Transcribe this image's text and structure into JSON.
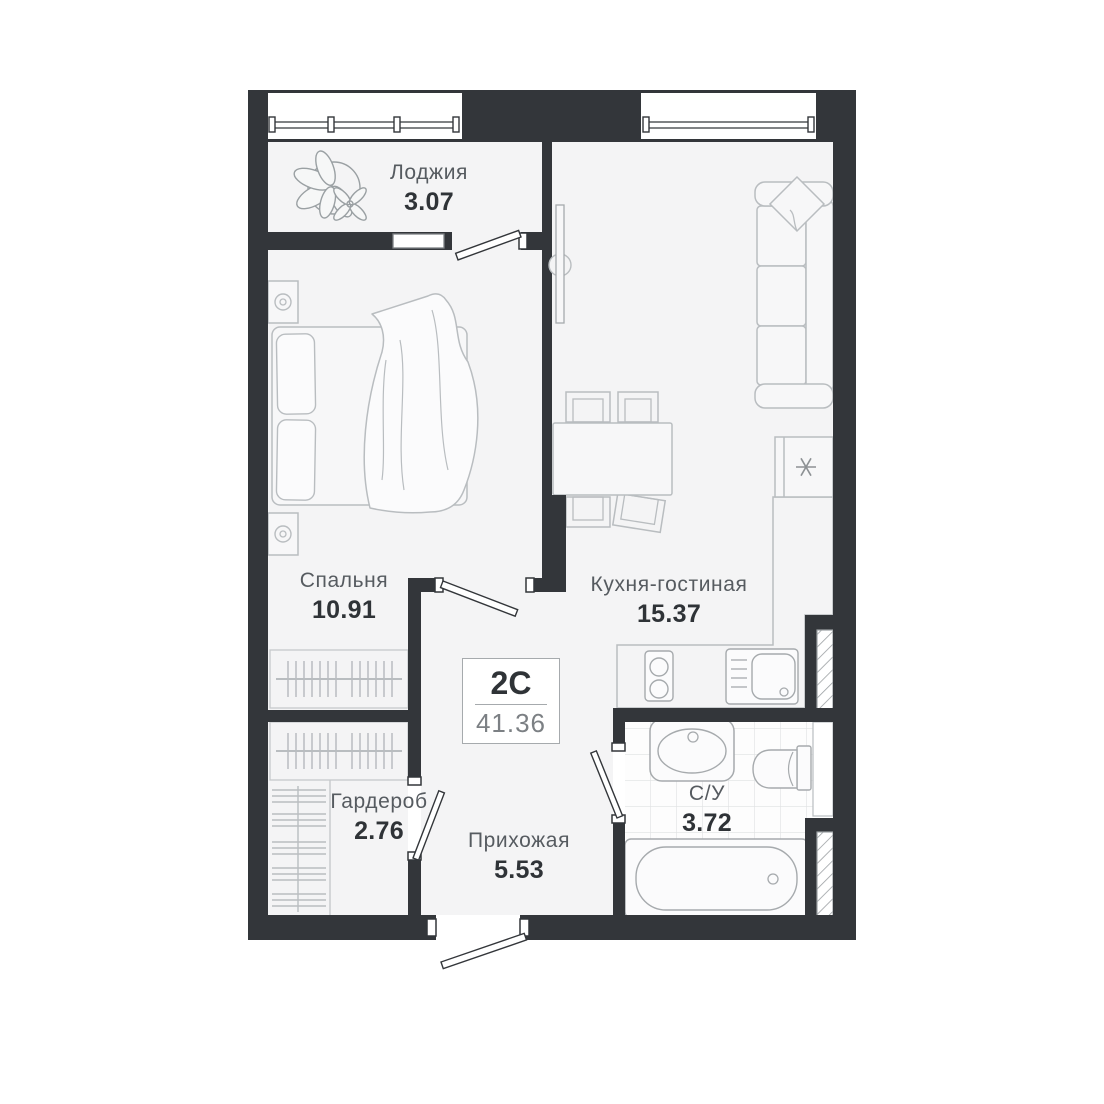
{
  "unit": {
    "type_label": "2С",
    "total_area": "41.36"
  },
  "rooms": {
    "loggia": {
      "name": "Лоджия",
      "area": "3.07"
    },
    "bedroom": {
      "name": "Спальня",
      "area": "10.91"
    },
    "kitchen_living": {
      "name": "Кухня-гостиная",
      "area": "15.37"
    },
    "wardrobe": {
      "name": "Гардероб",
      "area": "2.76"
    },
    "hallway": {
      "name": "Прихожая",
      "area": "5.53"
    },
    "bathroom": {
      "name": "С/У",
      "area": "3.72"
    }
  },
  "colors": {
    "wall": "#33363a",
    "floor": "#f4f4f5",
    "furniture_outline": "#b9bdc0",
    "fixture_outline": "#a6aaad",
    "tile_line": "#dfe1e2",
    "hatch_line": "#9ba0a3",
    "room_name_text": "#565b60",
    "area_value_text": "#2f3337",
    "unit_area_text": "#7c8084"
  },
  "icons": [
    "plant-icon",
    "bed-icon",
    "nightstand-lamp-icon",
    "sofa-icon",
    "pillow-icon",
    "dining-table-icon",
    "chair-icon",
    "fridge-snowflake-icon",
    "stove-icon",
    "kitchen-sink-icon",
    "washbasin-icon",
    "toilet-icon",
    "bathtub-icon",
    "hanger-rail-icon",
    "shelves-icon",
    "window-icon",
    "door-leaf-icon",
    "vent-shaft-icon"
  ]
}
